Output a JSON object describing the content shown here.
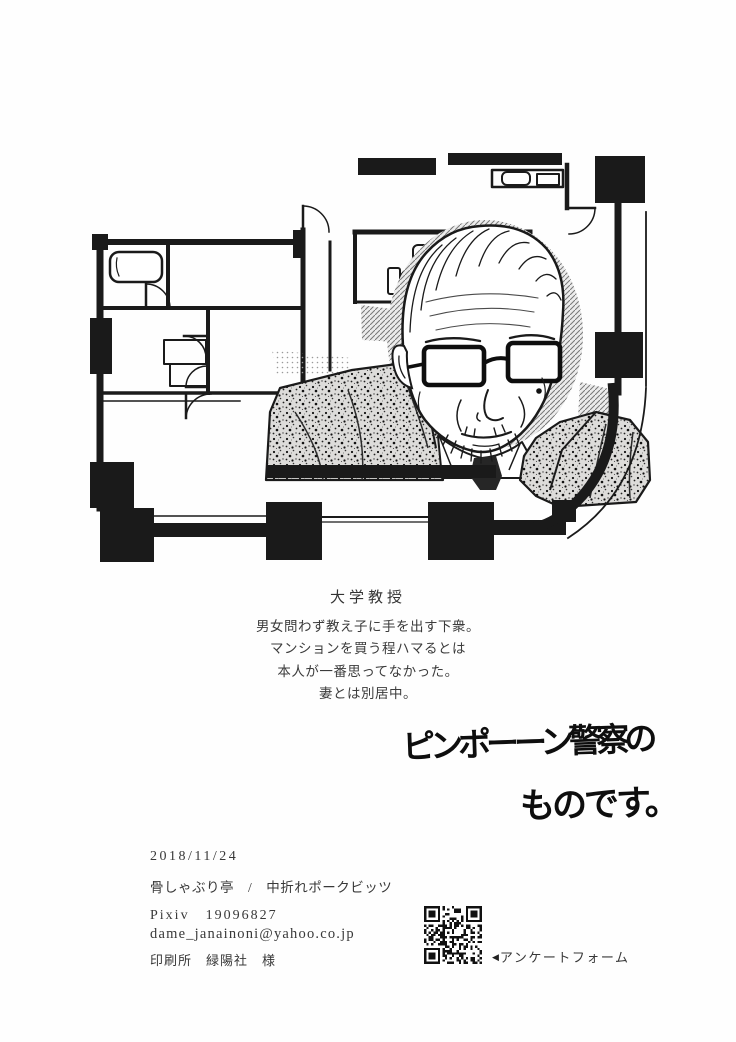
{
  "page": {
    "bg": "#ffffff",
    "ink": "#1a1a1a",
    "text_color": "#3a3a3a"
  },
  "profile": {
    "title": "大学教授",
    "bio_lines": [
      "男女問わず教え子に手を出す下衆。",
      "マンションを買う程ハマるとは",
      "本人が一番思ってなかった。",
      "妻とは別居中。"
    ]
  },
  "handwriting": {
    "line1": "ピンポーーン警察の",
    "line2": "ものです。"
  },
  "colophon": {
    "date": "2018/11/24",
    "circle": "骨しゃぶり亭　/　中折れポークビッツ",
    "pixiv": "Pixiv　19096827",
    "email": "dame_janainoni@yahoo.co.jp",
    "printer": "印刷所　緑陽社　様",
    "qr_arrow": "◀",
    "qr_label": "アンケートフォーム"
  }
}
